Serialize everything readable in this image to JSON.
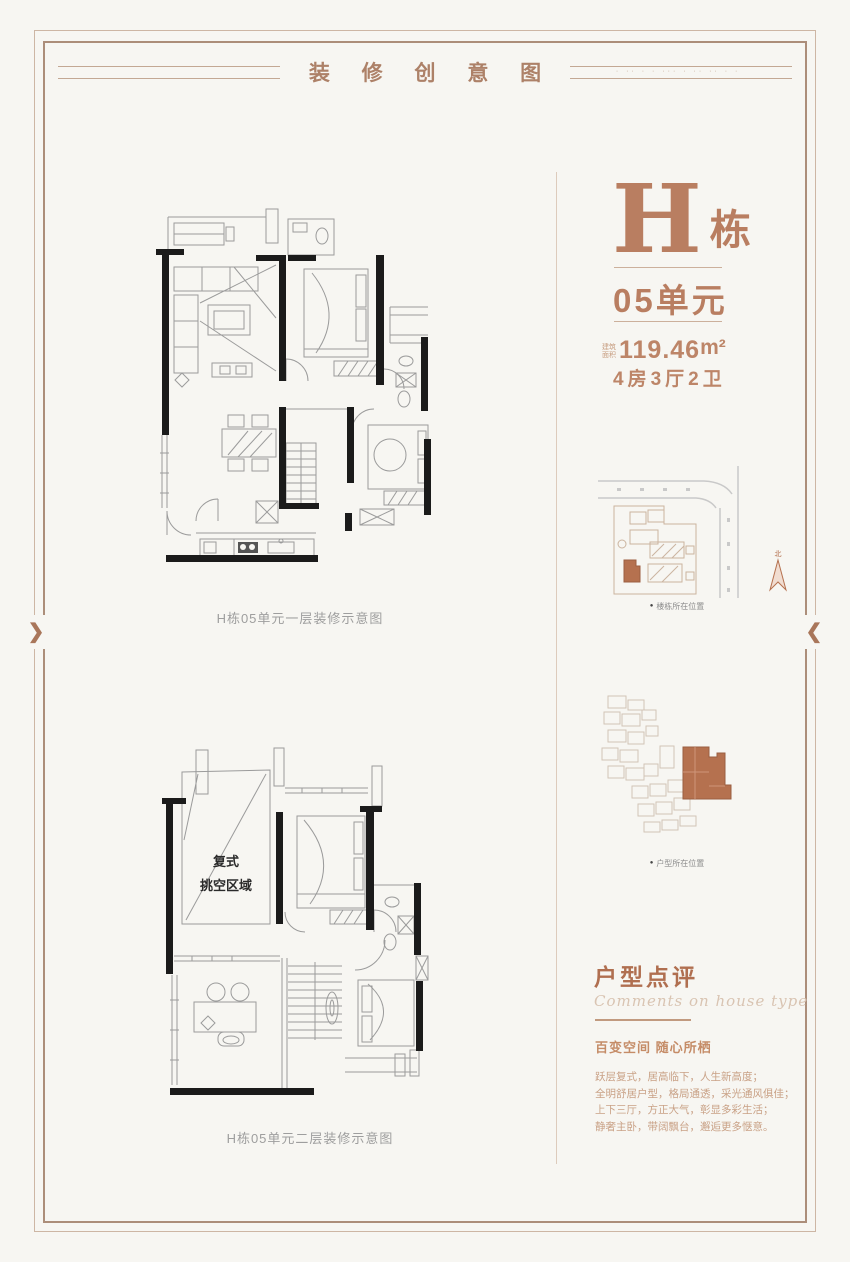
{
  "frame": {
    "title": "装 修 创 意 图",
    "title_side_dots": "· ·· ·  · ··· ·  ·· ··  · ·",
    "left_chevron": "❯",
    "right_chevron": "❮"
  },
  "plans": {
    "floor1": {
      "caption": "H栋05单元一层装修示意图"
    },
    "floor2": {
      "caption": "H栋05单元二层装修示意图",
      "void_line1": "复式",
      "void_line2": "挑空区域"
    }
  },
  "unit_info": {
    "building_letter": "H",
    "building_word": "栋",
    "unit_no": "05单元",
    "area_label_line1": "建筑",
    "area_label_line2": "面积",
    "area_value": "119.46",
    "area_unit": "m²",
    "rooms": "4房3厅2卫"
  },
  "site_map": {
    "caption": "楼栋所在位置",
    "compass": "北"
  },
  "floor_plate": {
    "caption": "户型所在位置"
  },
  "review": {
    "heading": "户型点评",
    "heading_en": "Comments on house type",
    "subtitle": "百变空间 随心所栖",
    "line1": "跃层复式，居高临下，人生新高度；",
    "line2": "全明舒居户型，格局通透，采光通风俱佳；",
    "line3": "上下三厅，方正大气，彰显多彩生活；",
    "line4": "静奢主卧，带阔飘台，邂逅更多惬意。"
  },
  "ui": {
    "bullet": "●"
  },
  "colors": {
    "accent": "#b97e61",
    "frame": "#ac8e7a",
    "wall": "#1b1b1b",
    "highlight_unit": "#b5714f",
    "background": "#f7f6f2"
  }
}
